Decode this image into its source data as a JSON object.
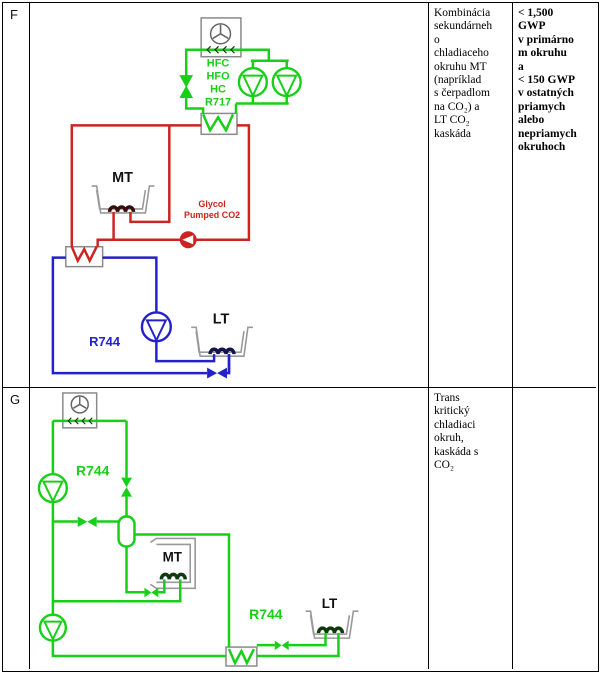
{
  "colors": {
    "green": "#17cf17",
    "red": "#cc2420",
    "blue": "#2421cc",
    "symbol_gray": "#8a8a8a",
    "case_gray": "#999999",
    "coil_dark_red": "#3a0b0b",
    "coil_dark_blue": "#14144a",
    "coil_dark_green": "#0e3a0e"
  },
  "table": {
    "rows": [
      {
        "label": "F",
        "description": "Kombinácia\nsekundárneh\no\nchladiaceho\nokruhu MT\n(napríklad\ns čerpadlom\nna CO₂) a\nLT CO₂\nkaskáda",
        "gwp": "< 1,500\nGWP\nv primárno\nm okruhu\na\n< 150 GWP\nv ostatných\npriamych\nalebo\nnepriamych\nokruhoch",
        "diagram": {
          "refrigerant_lines": [
            "HFC",
            "HFO",
            "HC",
            "R717"
          ],
          "mt_label": "MT",
          "lt_label": "LT",
          "r744_label": "R744",
          "glycol_line1": "Glycol",
          "glycol_line2": "Pumped CO2"
        }
      },
      {
        "label": "G",
        "description": "Trans\nkritický\nchladiaci\nokruh,\nkaskáda s\nCO₂",
        "gwp": "",
        "diagram": {
          "r744_upper": "R744",
          "r744_lower": "R744",
          "mt_label": "MT",
          "lt_label": "LT"
        }
      }
    ]
  }
}
